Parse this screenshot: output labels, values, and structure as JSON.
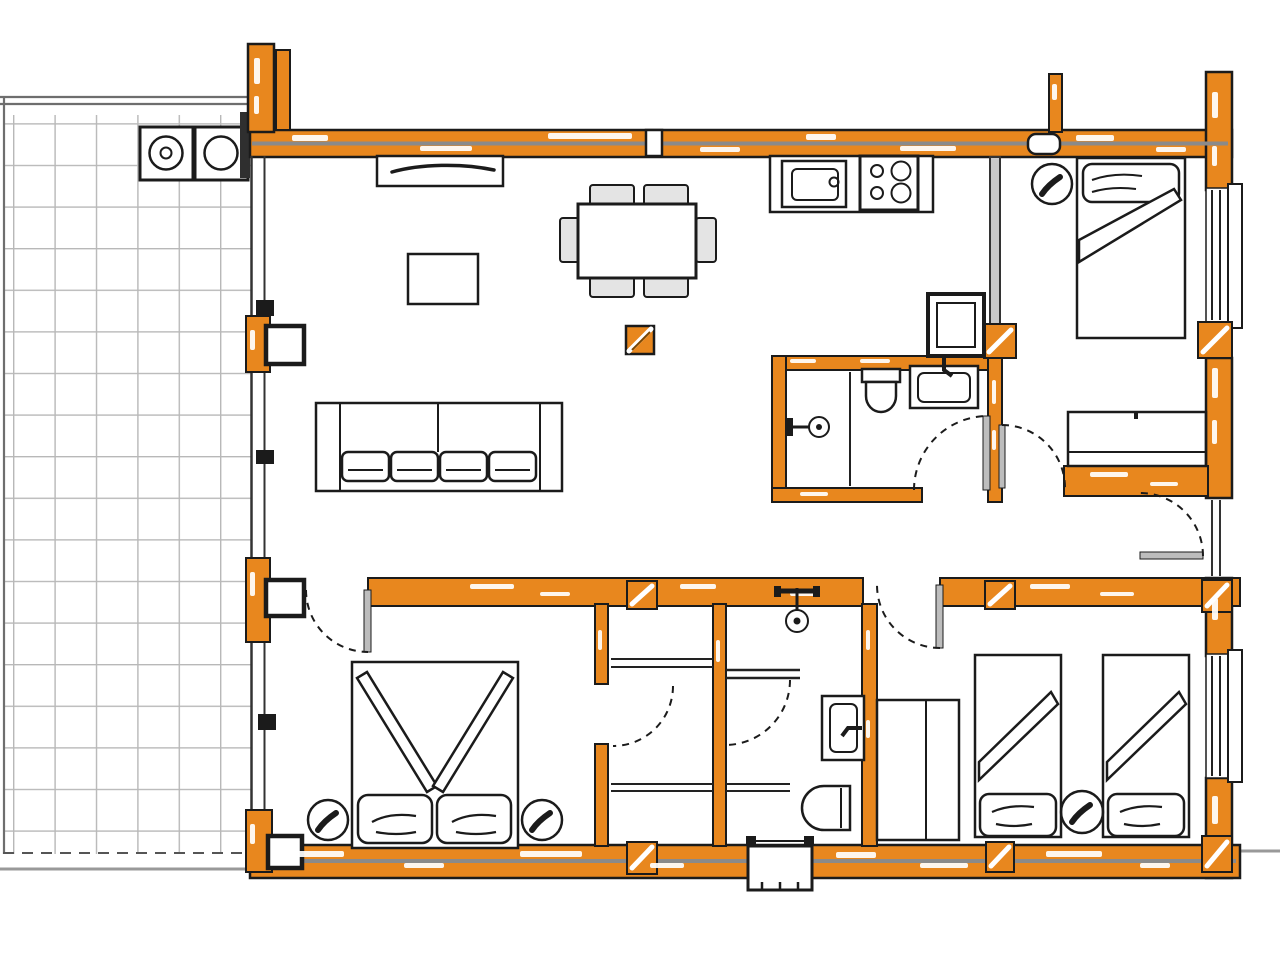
{
  "title": "house floor plan drawing",
  "colors": {
    "wall": "#E8871E",
    "outline": "#1B1B1B",
    "dark": "#2F2F2F",
    "grayLine": "#8A8A8A",
    "lightGray": "#C9C9C9",
    "leaf": "#BDBDBD",
    "grid": "#B8B8B8",
    "terraceEdge": "#6E6E6E",
    "outsideLine": "#999999",
    "chairFill": "#E4E4E4",
    "white": "#FFFFFF"
  },
  "legend": {
    "wall_material": "timber-frame-orange",
    "door_symbol": "dashed-quarter-circle-swing",
    "post_symbol": "orange-hatched-square",
    "window_symbol": "double-line-glazing"
  },
  "rooms": [
    {
      "id": "terrace",
      "items": [
        "tile-grid",
        "washing-machine",
        "dryer"
      ]
    },
    {
      "id": "living-dining",
      "items": [
        "sideboard",
        "tv-table",
        "sofa-4-seat",
        "dining-table",
        "dining-chairs-x6",
        "floor-marker"
      ]
    },
    {
      "id": "kitchen",
      "items": [
        "counter",
        "sink-unit",
        "cooktop-4-burner",
        "refrigerator"
      ]
    },
    {
      "id": "bathroom-1",
      "items": [
        "shower",
        "toilet",
        "washbasin"
      ]
    },
    {
      "id": "bedroom-top-right",
      "items": [
        "single-bed",
        "bedside-lamp",
        "desk"
      ]
    },
    {
      "id": "bedroom-bottom-left",
      "items": [
        "double-bed",
        "pillow-x2",
        "bedside-lamp-x2"
      ]
    },
    {
      "id": "bedroom-bottom-right",
      "items": [
        "single-bed-x2",
        "round-bedside-table",
        "wardrobe"
      ]
    },
    {
      "id": "closet",
      "items": [
        "shelf-x2"
      ]
    },
    {
      "id": "bathroom-2",
      "items": [
        "shower-head",
        "washbasin",
        "toilet"
      ]
    },
    {
      "id": "hall",
      "items": [
        "entrance-step"
      ]
    }
  ]
}
